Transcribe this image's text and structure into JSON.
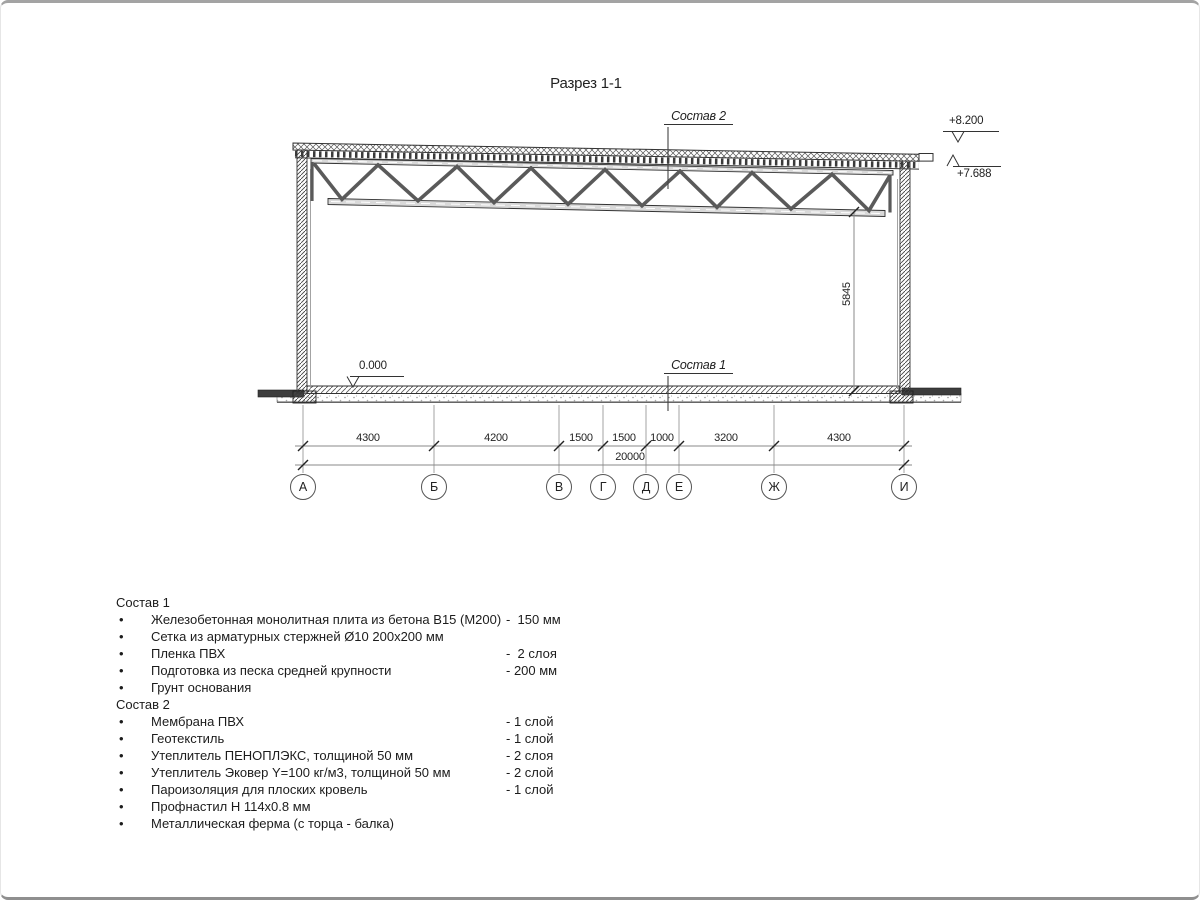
{
  "drawing": {
    "title": "Разрез 1-1",
    "roof_label": "Состав 2",
    "floor_label": "Состав 1",
    "elev_top": "+8.200",
    "elev_roof": "+7.688",
    "elev_floor": "0.000",
    "height_dim": "5845",
    "dims": [
      "4300",
      "4200",
      "1500",
      "1500",
      "1000",
      "3200",
      "4300"
    ],
    "total_dim": "20000",
    "axes": [
      "А",
      "Б",
      "В",
      "Г",
      "Д",
      "Е",
      "Ж",
      "И"
    ],
    "line_color": "#333333",
    "dim_line_color": "#888888"
  },
  "materials": {
    "sostav1": {
      "title": "Состав 1",
      "items": [
        {
          "label": "Железобетонная монолитная плита из бетона В15 (М200)",
          "value": "-  150 мм"
        },
        {
          "label": "Сетка из арматурных стержней Ø10 200х200 мм",
          "value": ""
        },
        {
          "label": "Пленка ПВХ",
          "value": "-  2 слоя"
        },
        {
          "label": "Подготовка из песка средней крупности",
          "value": "- 200 мм"
        },
        {
          "label": "Грунт основания",
          "value": ""
        }
      ]
    },
    "sostav2": {
      "title": "Состав 2",
      "items": [
        {
          "label": "Мембрана ПВХ",
          "value": "- 1 слой"
        },
        {
          "label": "Геотекстиль",
          "value": "- 1 слой"
        },
        {
          "label": "Утеплитель ПЕНОПЛЭКС, толщиной 50 мм",
          "value": "- 2 слоя"
        },
        {
          "label": "Утеплитель Эковер Y=100 кг/м3, толщиной 50 мм",
          "value": "- 2 слой"
        },
        {
          "label": "Пароизоляция для плоских кровель",
          "value": "- 1 слой"
        },
        {
          "label": "Профнастил Н 114х0.8 мм",
          "value": ""
        },
        {
          "label": "Металлическая ферма (с торца - балка)",
          "value": ""
        }
      ]
    }
  }
}
